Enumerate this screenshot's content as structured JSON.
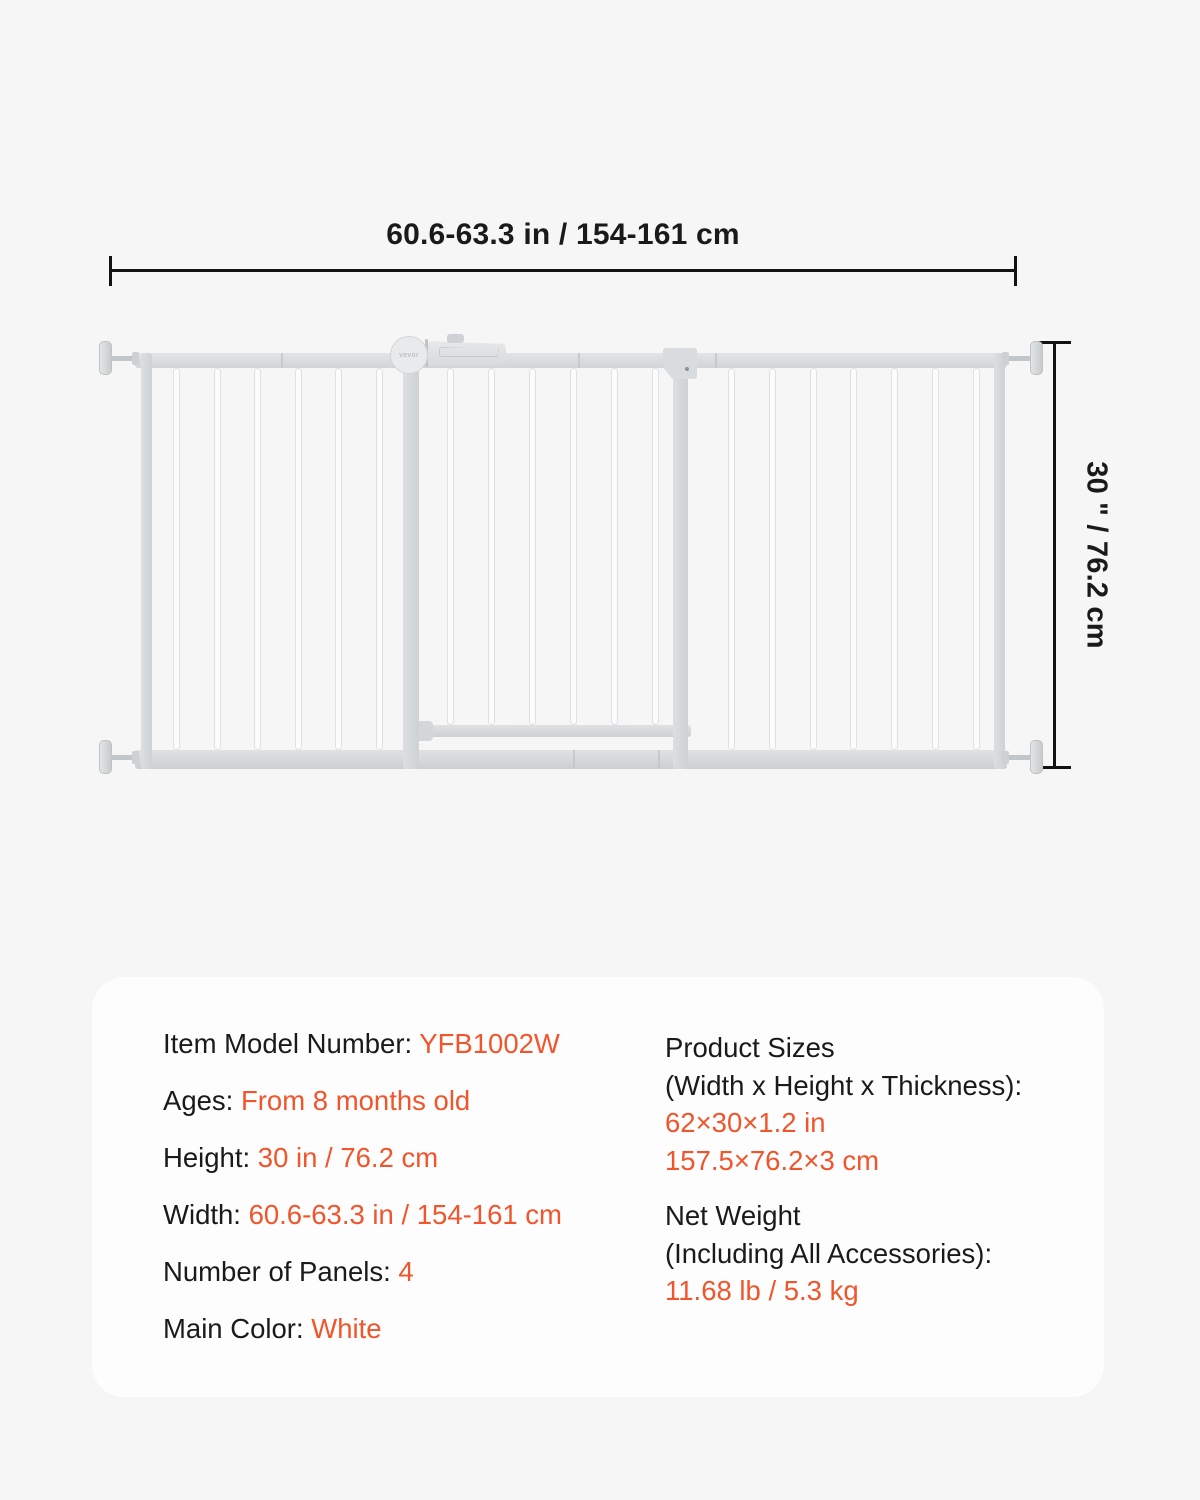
{
  "diagram": {
    "width_label": "60.6-63.3 in / 154-161 cm",
    "height_label": "30 \" / 76.2 cm",
    "gate_logo": "vevor"
  },
  "spec_card": {
    "left_rows": [
      {
        "label": "Item Model Number: ",
        "value": "YFB1002W"
      },
      {
        "label": "Ages: ",
        "value": "From 8 months old"
      },
      {
        "label": "Height: ",
        "value": "30 in / 76.2 cm"
      },
      {
        "label": "Width: ",
        "value": "60.6-63.3 in / 154-161 cm"
      },
      {
        "label": "Number of Panels: ",
        "value": "4"
      },
      {
        "label": "Main Color: ",
        "value": "White"
      }
    ],
    "right_blocks": [
      {
        "label_line1": "Product Sizes",
        "label_line2": "(Width x Height x Thickness):",
        "value_line1": "62×30×1.2 in",
        "value_line2": "157.5×76.2×3 cm"
      },
      {
        "label_line1": "Net Weight",
        "label_line2": "(Including All Accessories):",
        "value_line1": "11.68 lb / 5.3 kg",
        "value_line2": ""
      }
    ]
  },
  "colors": {
    "accent_orange": "#F0552B",
    "text_black": "#1A1A1A",
    "card_background": "#FDFDFE",
    "page_background": "#F6F6F7",
    "gate_gray": "#D5D8DA"
  }
}
